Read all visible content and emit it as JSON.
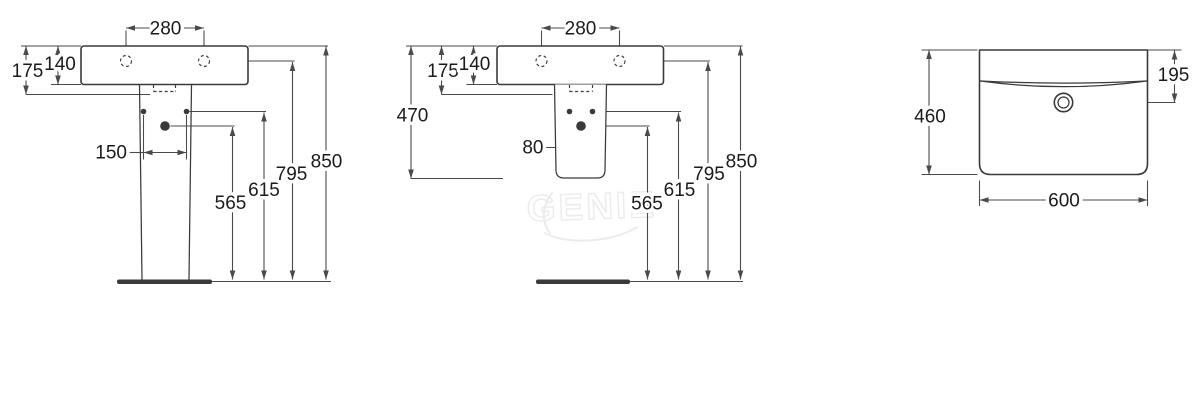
{
  "diagram": {
    "type": "washbasin-installation-dimension-drawing",
    "watermark": "GENIE",
    "colors": {
      "background": "#ffffff",
      "line": "#3a3a3a",
      "dimension": "#4a4a4a",
      "text": "#1b1b1b",
      "watermark": "#ececec"
    },
    "front_pedestal": {
      "tap_hole_spacing": "280",
      "front_edge_depth": "175",
      "basin_depth": "140",
      "fixing_hole_spacing": "150",
      "waste_outlet_height": "565",
      "fixing_hole_height": "615",
      "tap_hole_height": "795",
      "rim_height": "850"
    },
    "front_semi_pedestal": {
      "tap_hole_spacing": "280",
      "front_edge_depth": "175",
      "basin_depth": "140",
      "semi_pedestal_drop": "470",
      "fixing_hole_spacing": "80",
      "waste_outlet_height": "565",
      "fixing_hole_height": "615",
      "tap_hole_height": "795",
      "rim_height": "850"
    },
    "top_view": {
      "overall_depth": "460",
      "tap_hole_offset": "195",
      "overall_width": "600"
    }
  }
}
